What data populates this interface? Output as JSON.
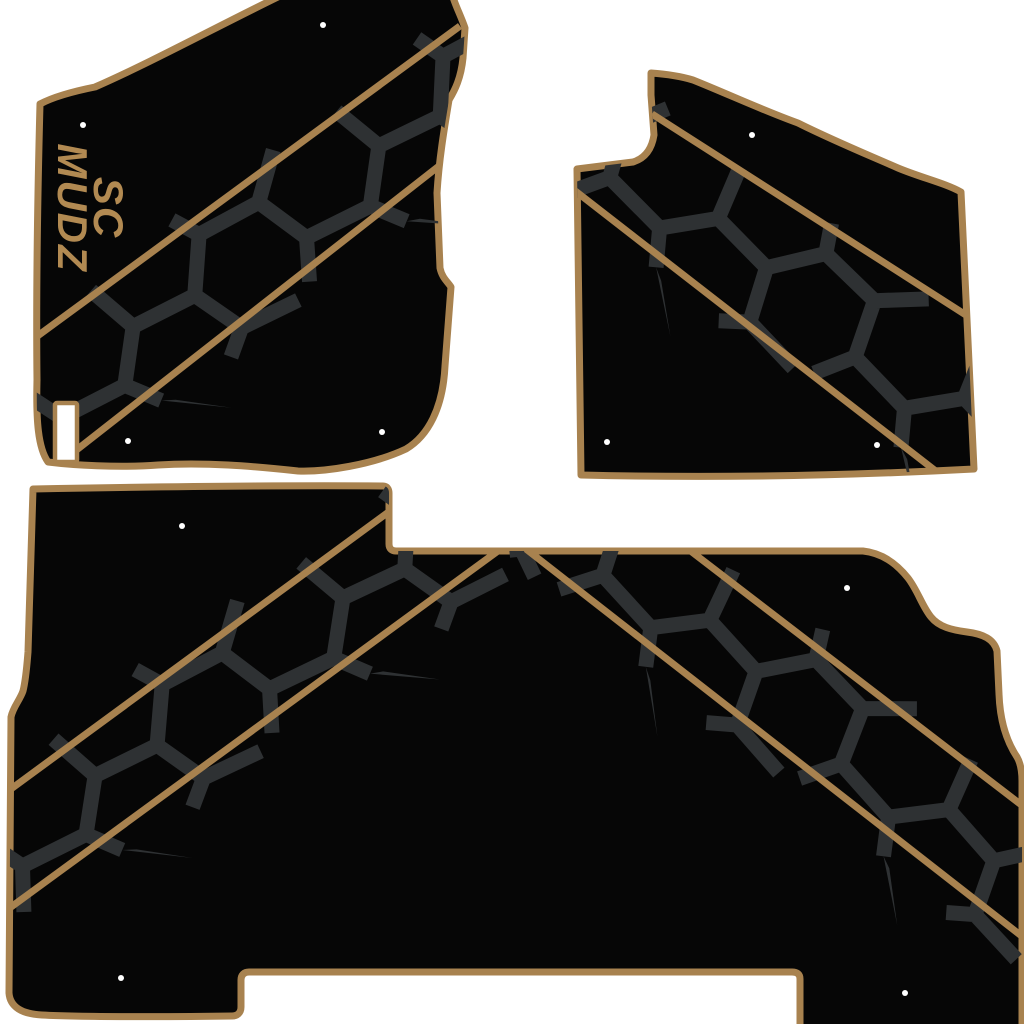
{
  "title": "Custom vehicle floor mat set product graphic",
  "logo": {
    "line1": "SC",
    "line2": "MUDZ"
  },
  "mats": [
    {
      "name": "front-left-mat",
      "mounting_holes": 4,
      "has_logo": true,
      "has_heel_pad": true,
      "stripe_direction": "bottom-left to top-right"
    },
    {
      "name": "front-right-mat",
      "mounting_holes": 3,
      "has_logo": false,
      "has_heel_pad": false,
      "stripe_direction": "top-left to bottom-right"
    },
    {
      "name": "rear-mat",
      "mounting_holes": 4,
      "has_logo": false,
      "has_heel_pad": false,
      "stripe_direction": "chevron apex at top"
    }
  ],
  "colors": {
    "bg": "#ffffff",
    "mat": "#060606",
    "trim": "#a8824f",
    "crack": "#2e3133",
    "logo": "#b28a52",
    "hole": "#ffffff"
  }
}
